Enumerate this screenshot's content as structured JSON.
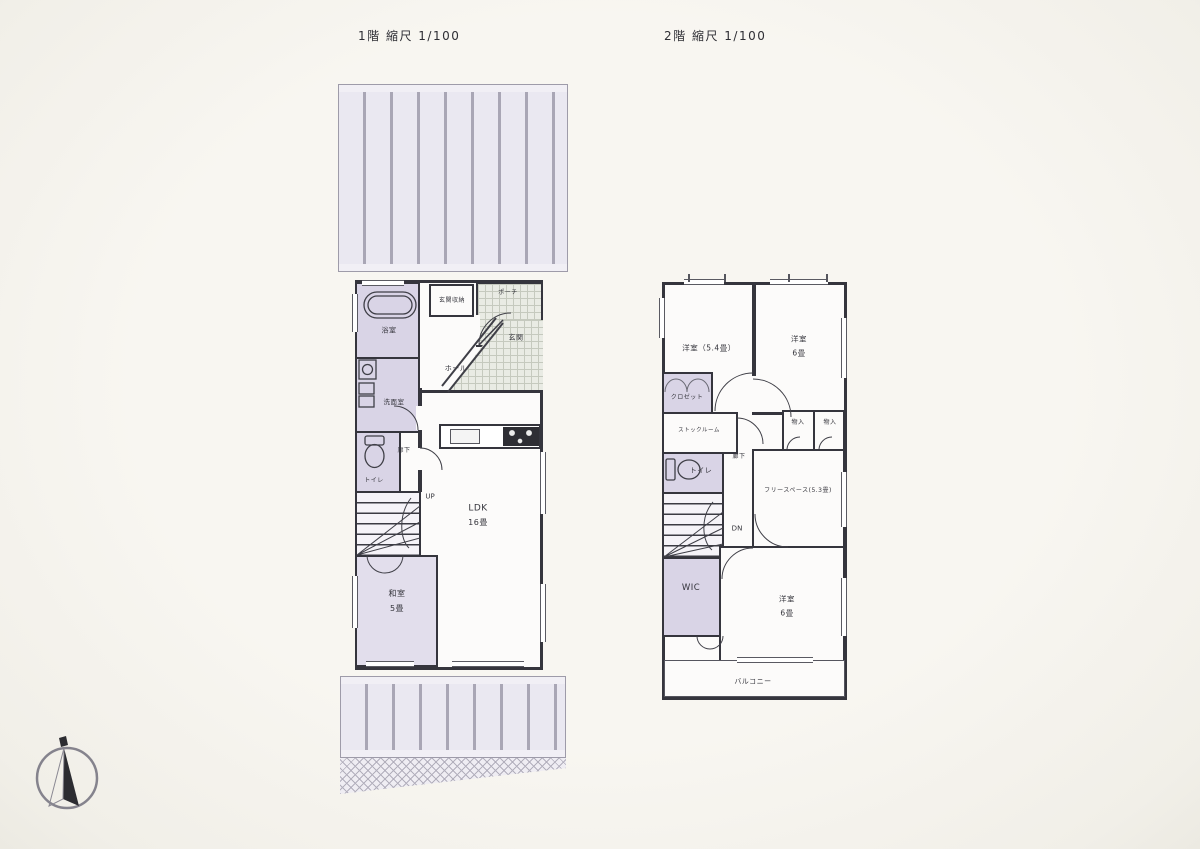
{
  "titles": {
    "floor1": "1階 縮尺 1/100",
    "floor2": "2階 縮尺 1/100"
  },
  "floor1": {
    "rooms": {
      "bathroom": "浴室",
      "entrance_storage": "玄関収納",
      "porch": "ポーチ",
      "entrance": "玄関",
      "hall": "ホール",
      "washroom": "洗面室",
      "toilet": "トイレ",
      "corridor": "廊下",
      "stairs": "UP",
      "ldk": "LDK",
      "ldk_size": "16畳",
      "japanese_room": "和室",
      "japanese_room_size": "5畳"
    }
  },
  "floor2": {
    "rooms": {
      "bedroom_a": "洋室（5.4畳）",
      "bedroom_b": "洋室",
      "bedroom_b_size": "6畳",
      "closet": "クロゼット",
      "stock_room": "ストックルーム",
      "storage_a": "物入",
      "storage_b": "物入",
      "toilet": "トイレ",
      "corridor": "廊下",
      "stairs": "DN",
      "free_space": "フリースペース(5.3畳)",
      "wic": "WIC",
      "bedroom_c": "洋室",
      "bedroom_c_size": "6畳",
      "balcony": "バルコニー"
    }
  },
  "icons": {
    "compass": "north-arrow-icon"
  },
  "colors": {
    "wall": "#35353d",
    "room_tint": "#d9d4e6",
    "room_tint_light": "#e2deec",
    "tile": "#e9ebe4",
    "deck_fill": "#eae8f1",
    "deck_line": "#a9a6b5",
    "paper": "#f8f6f1"
  }
}
